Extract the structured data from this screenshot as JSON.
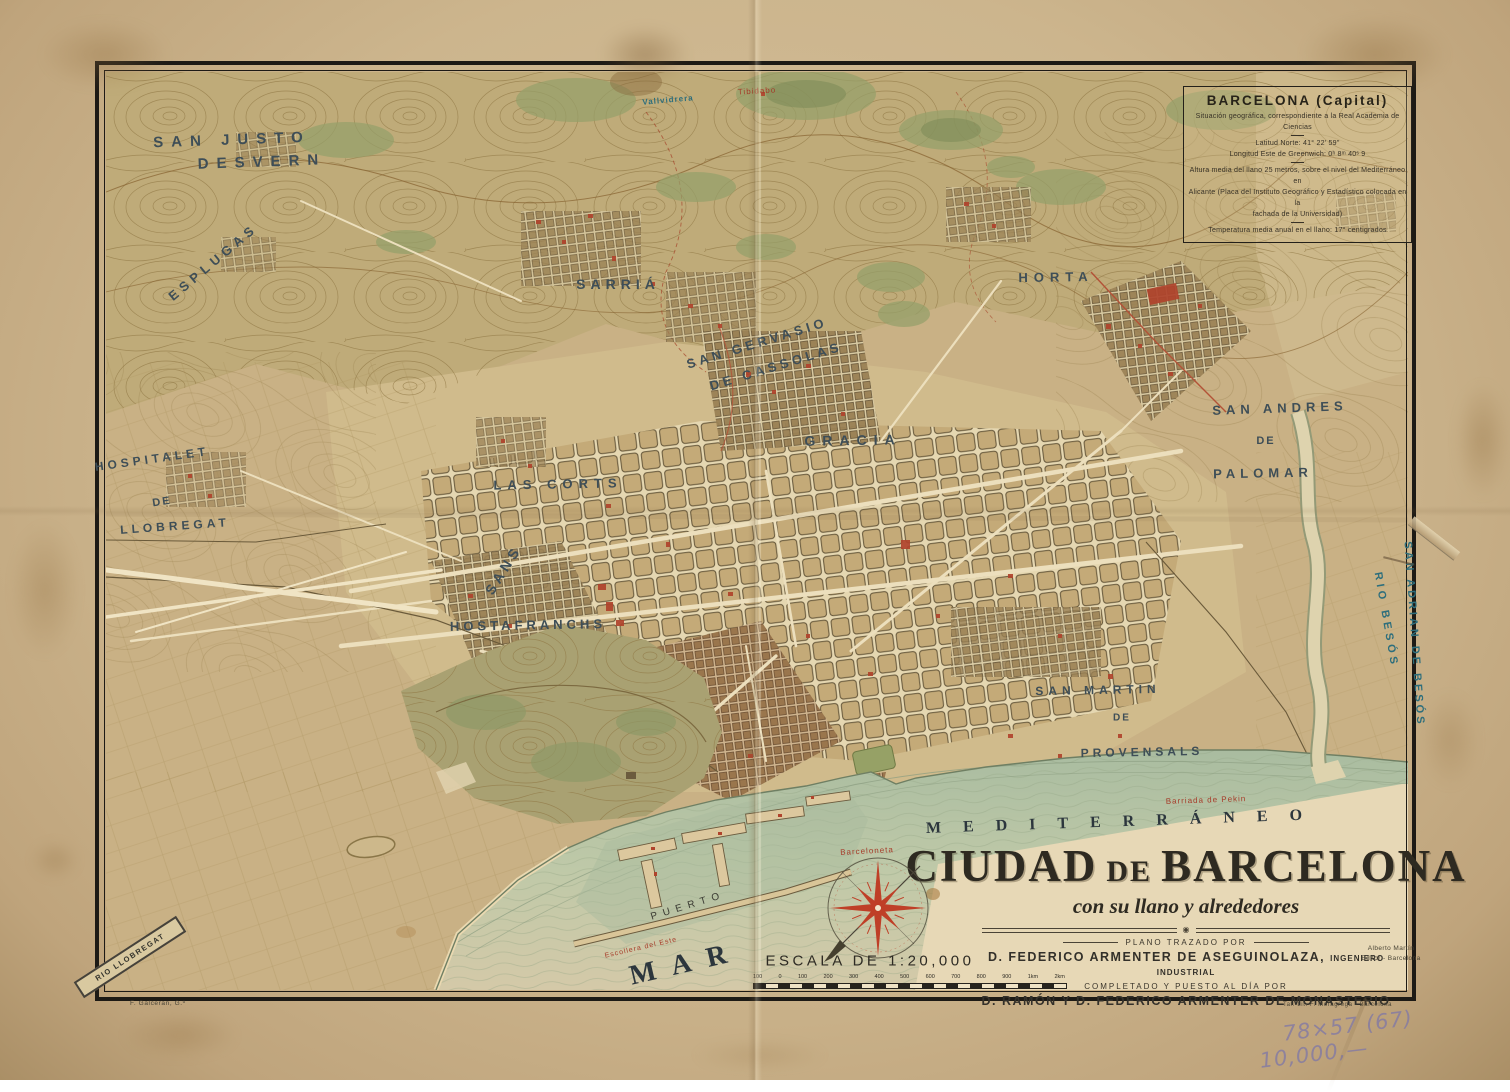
{
  "info_box": {
    "title": "BARCELONA (Capital)",
    "subtitle": "Situación geográfica, correspondiente a la Real Academia de Ciencias",
    "lat": "Latitud Norte: 41° 22' 59\"",
    "lon": "Longitud Este de Greenwich: 0ʰ 8ᵐ 40ˢ 9",
    "alt1": "Altura media del llano 25 metros, sobre el nivel del Mediterráneo en",
    "alt2": "Alicante (Placa del Instituto Geográfico y Estadístico colocada en la",
    "alt3": "fachada de la Universidad)",
    "temp": "Temperatura media anual en el llano: 17° centigrados"
  },
  "cartouche": {
    "title_1": "CIUDAD",
    "title_de": "DE",
    "title_2": "BARCELONA",
    "subtitle": "con su llano y alrededores",
    "drawn_by": "PLANO TRAZADO POR",
    "author1": "D. FEDERICO ARMENTER DE ASEGUINOLAZA,",
    "author1_title": "INGENIERO INDUSTRIAL",
    "updated_by": "COMPLETADO Y PUESTO AL DÍA POR",
    "author2": "D. RAMÓN Y D. FEDERICO ARMENTER DE MONASTERIO",
    "publisher1": "Alberto Martín",
    "publisher2": "Editor - Barcelona"
  },
  "scale": {
    "label": "ESCALA DE 1:20,000",
    "ticks": [
      "100",
      "0",
      "100",
      "200",
      "300",
      "400",
      "500",
      "600",
      "700",
      "800",
      "900",
      "1km",
      "2km"
    ]
  },
  "credits": {
    "engraver": "F. Galceran, G.º",
    "printer": "Tal.-Lit. F. Moragrega - Barcelona"
  },
  "annotations": {
    "pencil1": "78×57 (67)",
    "pencil2": "10,000,—"
  },
  "places": {
    "san_justo": "SAN JUSTO",
    "desvern": "DESVERN",
    "esplugas": "ESPLUGAS",
    "hospitalet_1": "HOSPITALET",
    "hospitalet_2": "DE",
    "hospitalet_3": "LLOBREGAT",
    "sarria": "SARRIÁ",
    "san_gervasio_1": "SAN GERVASIO",
    "san_gervasio_2": "DE CASSOLAS",
    "gracia": "GRACIA",
    "horta": "HORTA",
    "san_andres_1": "SAN ANDRES",
    "san_andres_2": "DE",
    "san_andres_3": "PALOMAR",
    "las_corts": "LAS CORTS",
    "sans": "SANS",
    "hostafranchs": "HOSTAFRANCHS",
    "san_martin_1": "SAN MARTIN",
    "san_martin_2": "DE",
    "san_martin_3": "PROVENSALS",
    "mediterraneo": "MEDITERRÁNEO",
    "mar": "MAR",
    "puerto": "PUERTO",
    "rio_besos": "RIO BESÓS",
    "san_adrian": "SAN ADRIAN DE BESÓS",
    "rio_llobregat": "RIO LLOBREGAT",
    "barceloneta": "Barceloneta",
    "barriada_pekin": "Barriada de Pekin",
    "escollera": "Escollera del Este",
    "vallvidrera": "Vallvidrera",
    "tibidabo": "Tibidabo"
  },
  "colors": {
    "paper": "#ccb58d",
    "terrain": "#c9b185",
    "sea": "#b9c6ab",
    "label_blue": "#3e4e57",
    "label_teal": "#2d6e7c",
    "accent_red": "#b0432c",
    "frame": "#1d1a15"
  }
}
